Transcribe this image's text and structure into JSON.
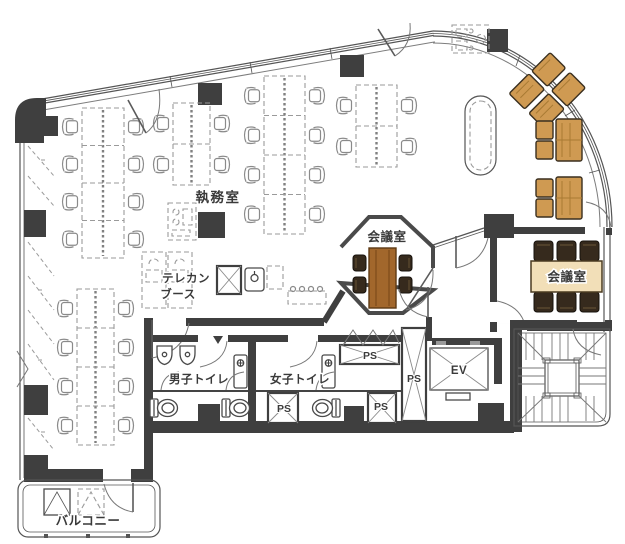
{
  "plan": {
    "rooms": {
      "office": {
        "label": "執務室"
      },
      "meeting_center": {
        "label": "会議室"
      },
      "meeting_right": {
        "label": "会議室"
      },
      "telecom_booth": {
        "label_line1": "テレカン",
        "label_line2": "ブース"
      },
      "mens_toilet": {
        "label": "男子トイレ"
      },
      "womens_toilet": {
        "label": "女子トイレ"
      },
      "balcony": {
        "label": "バルコニー"
      }
    },
    "facilities": {
      "elevator": {
        "label": "EV"
      },
      "pipe_space": {
        "label": "PS"
      }
    },
    "colors": {
      "wall": "#3f3f3f",
      "line": "#666666",
      "wood": "#a2672c",
      "wood_dark": "#5d3a14",
      "sofa": "#cf9a52",
      "chair_dark": "#362a1d",
      "beige": "#f2dfb8",
      "bg": "#ffffff"
    }
  }
}
